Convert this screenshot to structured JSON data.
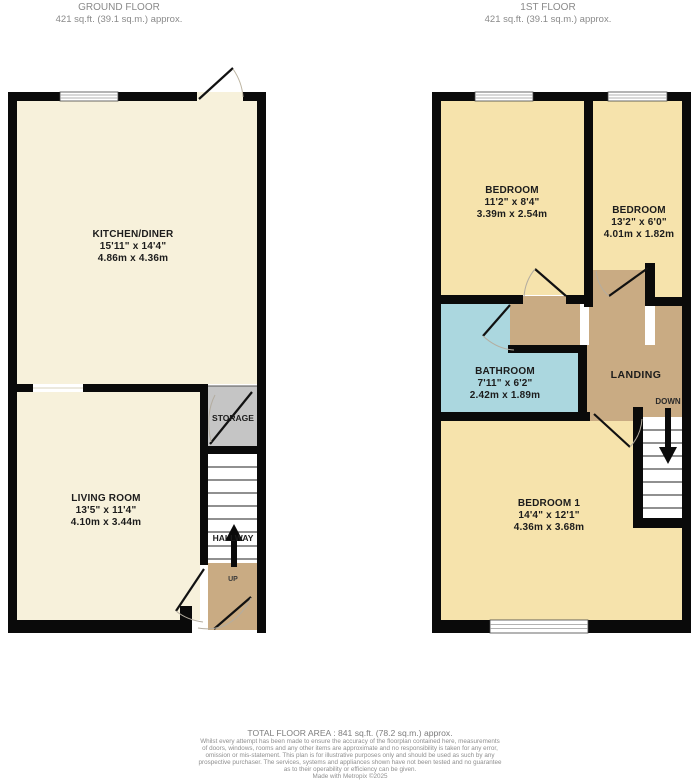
{
  "ground_floor": {
    "title": "GROUND FLOOR",
    "area_line": "421 sq.ft. (39.1 sq.m.) approx.",
    "rooms": {
      "kitchen_diner": {
        "name": "KITCHEN/DINER",
        "imperial": "15'11\"  x 14'4\"",
        "metric": "4.86m  x 4.36m"
      },
      "living_room": {
        "name": "LIVING ROOM",
        "imperial": "13'5\"  x 11'4\"",
        "metric": "4.10m  x 3.44m"
      },
      "storage": {
        "name": "STORAGE"
      },
      "hallway": {
        "name": "HALLWAY"
      },
      "up": {
        "name": "UP"
      }
    }
  },
  "first_floor": {
    "title": "1ST FLOOR",
    "area_line": "421 sq.ft. (39.1 sq.m.) approx.",
    "rooms": {
      "bedroom_front": {
        "name": "BEDROOM",
        "imperial": "11'2\"  x 8'4\"",
        "metric": "3.39m  x 2.54m"
      },
      "bedroom_side": {
        "name": "BEDROOM",
        "imperial": "13'2\"  x 6'0\"",
        "metric": "4.01m  x 1.82m"
      },
      "bathroom": {
        "name": "BATHROOM",
        "imperial": "7'11\"  x 6'2\"",
        "metric": "2.42m  x 1.89m"
      },
      "bedroom_1": {
        "name": "BEDROOM 1",
        "imperial": "14'4\"  x 12'1\"",
        "metric": "4.36m  x 3.68m"
      },
      "landing": {
        "name": "LANDING"
      },
      "down": {
        "name": "DOWN"
      }
    }
  },
  "footer": {
    "total_area": "TOTAL FLOOR AREA : 841 sq.ft. (78.2 sq.m.) approx.",
    "disclaimer_lines": [
      "Whilst every attempt has been made to ensure the accuracy of the floorplan contained here, measurements",
      "of doors, windows, rooms and any other items are approximate and no responsibility is taken for any error,",
      "omission or mis-statement. This plan is for illustrative purposes only and should be used as such by any",
      "prospective purchaser. The services, systems and appliances shown have not been tested and no guarantee",
      "as to their operability or efficiency can be given.",
      "Made with Metropix ©2025"
    ]
  },
  "colors": {
    "ground_room_cream": "#F7F1DB",
    "bedroom_yellow": "#F6E3AC",
    "landing_tan": "#C9AB83",
    "bathroom_blue": "#ABD7DF",
    "storage_grey": "#C5C5C5",
    "wall_black": "#0A0A0A"
  }
}
